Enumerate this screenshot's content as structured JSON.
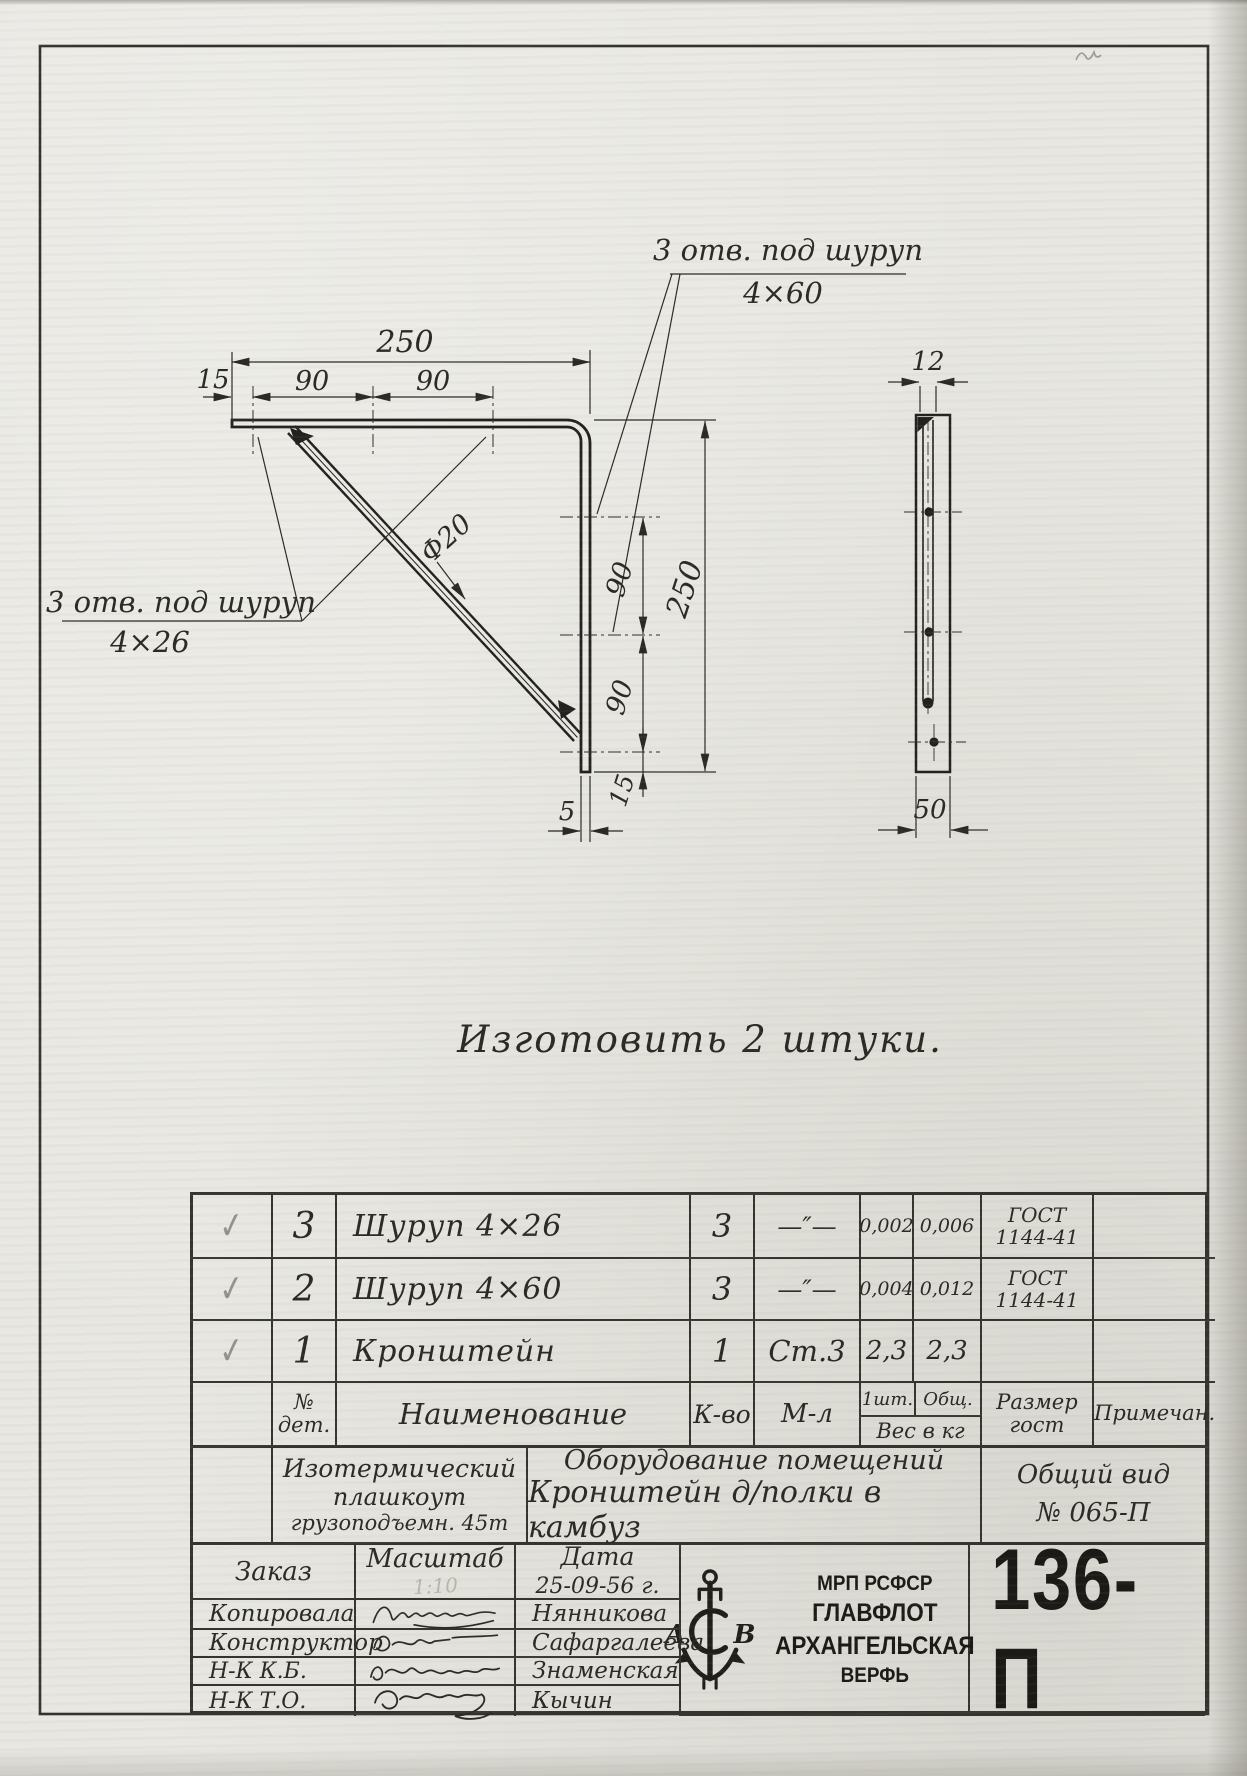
{
  "colors": {
    "paper": "#e8e7e1",
    "ink": "#2b2a25",
    "pencil": "#93928b"
  },
  "drawing": {
    "note": "Изготовить  2 штуки.",
    "labels": {
      "top_holes_1": "3 отв. под шуруп",
      "top_holes_2": "4×60",
      "left_holes_1": "3 отв. под шуруп",
      "left_holes_2": "4×26",
      "rod_diameter": "Ф20"
    },
    "dims": {
      "top_total": "250",
      "top_offset": "15",
      "top_span1": "90",
      "top_span2": "90",
      "right_total": "250",
      "right_span1": "90",
      "right_span2": "90",
      "right_offset": "15",
      "foot": "5",
      "side_thickness": "12",
      "side_width": "50"
    }
  },
  "parts_table": {
    "header": {
      "no_1": "№",
      "no_2": "дет.",
      "name": "Наименование",
      "qty": "К-во",
      "material": "М-л",
      "weight_one": "1шт.",
      "weight_total": "Общ.",
      "weight_label": "Вес в кг",
      "size_1": "Размер",
      "size_2": "гост",
      "note": "Примечан."
    },
    "rows": [
      {
        "check": "✓",
        "no": "3",
        "name": "Шуруп 4×26",
        "qty": "3",
        "material": "—″—",
        "weight_one": "0,002",
        "weight_total": "0,006",
        "gost_1": "ГОСТ",
        "gost_2": "1144-41",
        "note": ""
      },
      {
        "check": "✓",
        "no": "2",
        "name": "Шуруп 4×60",
        "qty": "3",
        "material": "—″—",
        "weight_one": "0,004",
        "weight_total": "0,012",
        "gost_1": "ГОСТ",
        "gost_2": "1144-41",
        "note": ""
      },
      {
        "check": "✓",
        "no": "1",
        "name": "Кронштейн",
        "qty": "1",
        "material": "Ст.3",
        "weight_one": "2,3",
        "weight_total": "2,3",
        "gost_1": "",
        "gost_2": "",
        "note": ""
      }
    ]
  },
  "project_block": {
    "object_1": "Изотермический",
    "object_2": "плашкоут",
    "object_3": "грузоподъемн. 45т",
    "title_1": "Оборудование помещений",
    "title_2": "Кронштейн д/полки в камбуз",
    "view_1": "Общий вид",
    "view_2": "№ 065-П"
  },
  "title_block": {
    "order_label": "Заказ",
    "scale_label": "Масштаб",
    "scale_value": "1:10",
    "date_label": "Дата",
    "date_value": "25-09-56 г.",
    "signature_rows": [
      {
        "role": "Копировала",
        "name": "Нянникова"
      },
      {
        "role": "Конструктор",
        "name": "Сафаргалеева"
      },
      {
        "role": "Н-К К.Б.",
        "name": "Знаменская"
      },
      {
        "role": "Н-К Т.О.",
        "name": "Кычин"
      }
    ],
    "org_lines": [
      "МРП РСФСР",
      "ГЛАВФЛОТ",
      "АРХАНГЕЛЬСКАЯ",
      "ВЕРФЬ"
    ],
    "logo_letters": [
      "А",
      "С",
      "В"
    ],
    "drawing_number": "136-П"
  }
}
